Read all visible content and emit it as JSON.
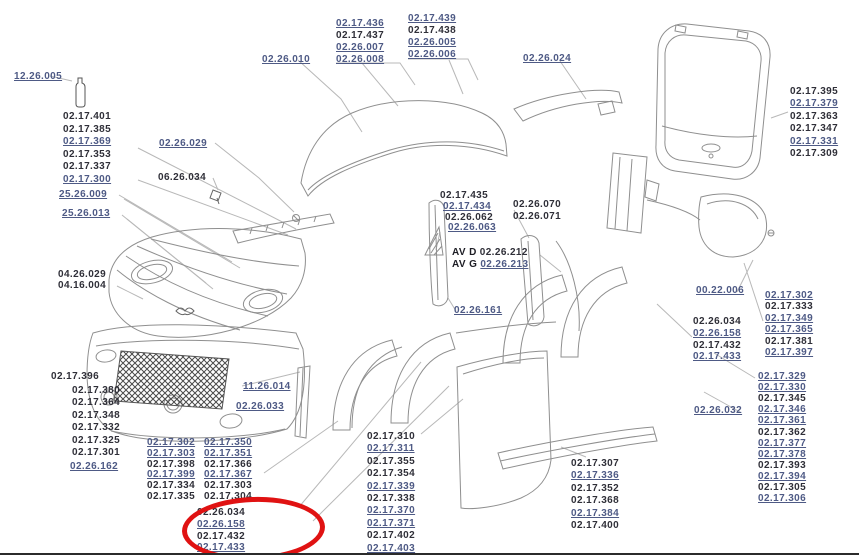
{
  "colors": {
    "text": "#2f2f38",
    "link": "#4e5a85",
    "art": "#8f8f8f",
    "leader": "#b8b8b8",
    "highlight": "#e01212",
    "background": "#ffffff"
  },
  "callouts": [
    {
      "id": "12-26-005",
      "t": "12.26.005",
      "x": 14,
      "y": 71,
      "link": true
    },
    {
      "id": "02-26-010",
      "t": "02.26.010",
      "x": 262,
      "y": 54,
      "link": true
    },
    {
      "id": "02-26-029",
      "t": "02.26.029",
      "x": 159,
      "y": 138,
      "link": true
    },
    {
      "id": "06-26-034",
      "t": "06.26.034",
      "x": 158,
      "y": 172,
      "link": false
    },
    {
      "id": "25-26-009",
      "t": "25.26.009",
      "x": 59,
      "y": 189,
      "link": true
    },
    {
      "id": "25-26-013",
      "t": "25.26.013",
      "x": 62,
      "y": 208,
      "link": true
    },
    {
      "id": "04-26-029",
      "t": "04.26.029",
      "x": 58,
      "y": 269,
      "link": false
    },
    {
      "id": "04-16-004",
      "t": "04.16.004",
      "x": 58,
      "y": 280,
      "link": false
    },
    {
      "id": "02-26-024",
      "t": "02.26.024",
      "x": 523,
      "y": 53,
      "link": true
    },
    {
      "id": "00-22-006",
      "t": "00.22.006",
      "x": 696,
      "y": 285,
      "link": true
    },
    {
      "id": "02-26-032",
      "t": "02.26.032",
      "x": 694,
      "y": 405,
      "link": true
    },
    {
      "id": "11-26-014",
      "t": "11.26.014",
      "x": 243,
      "y": 381,
      "link": true
    },
    {
      "id": "02-26-033",
      "t": "02.26.033",
      "x": 236,
      "y": 401,
      "link": true
    },
    {
      "id": "02-26-162",
      "t": "02.26.162",
      "x": 70,
      "y": 461,
      "link": true
    },
    {
      "id": "02-26-161",
      "t": "02.26.161",
      "x": 454,
      "y": 305,
      "link": true
    },
    {
      "id": "av-d-02-26-212",
      "prefix": "AV D",
      "t": "02.26.212",
      "x": 452,
      "y": 247,
      "link": false
    },
    {
      "id": "av-g-02-26-213",
      "prefix": "AV G",
      "t": "02.26.213",
      "x": 452,
      "y": 259,
      "link": true
    }
  ],
  "lists": [
    {
      "id": "front-left-upper",
      "x": 63,
      "y": 111,
      "lh": 12.5,
      "items": [
        {
          "t": "02.17.401"
        },
        {
          "t": "02.17.385"
        },
        {
          "t": "02.17.369",
          "u": true
        },
        {
          "t": "02.17.353"
        },
        {
          "t": "02.17.337"
        },
        {
          "t": "02.17.300",
          "u": true
        }
      ]
    },
    {
      "id": "top-center-left",
      "x": 336,
      "y": 18,
      "lh": 12,
      "items": [
        {
          "t": "02.17.436",
          "u": true
        },
        {
          "t": "02.17.437"
        },
        {
          "t": "02.26.007",
          "u": true
        },
        {
          "t": "02.26.008",
          "u": true
        }
      ]
    },
    {
      "id": "top-center-right",
      "x": 408,
      "y": 13,
      "lh": 12,
      "items": [
        {
          "t": "02.17.439",
          "u": true
        },
        {
          "t": "02.17.438"
        },
        {
          "t": "02.26.005",
          "u": true
        },
        {
          "t": "02.26.006",
          "u": true
        }
      ]
    },
    {
      "id": "hatch-right",
      "x": 790,
      "y": 86,
      "lh": 12.4,
      "items": [
        {
          "t": "02.17.395"
        },
        {
          "t": "02.17.379",
          "u": true
        },
        {
          "t": "02.17.363"
        },
        {
          "t": "02.17.347"
        },
        {
          "t": "02.17.331",
          "u": true
        },
        {
          "t": "02.17.309"
        }
      ]
    },
    {
      "id": "center-pillar",
      "x": 440,
      "y": 190,
      "lh": 10.8,
      "items": [
        {
          "t": "02.17.435"
        },
        {
          "t": "02.17.434",
          "u": true,
          "dx": 3
        },
        {
          "t": "02.26.062",
          "dx": 5
        },
        {
          "t": "02.26.063",
          "u": true,
          "dx": 8
        }
      ]
    },
    {
      "id": "quarter-upper",
      "x": 513,
      "y": 199,
      "lh": 11.5,
      "items": [
        {
          "t": "02.26.070"
        },
        {
          "t": "02.26.071"
        }
      ]
    },
    {
      "id": "rear-inner",
      "x": 693,
      "y": 316,
      "lh": 11.8,
      "items": [
        {
          "t": "02.26.034"
        },
        {
          "t": "02.26.158",
          "u": true
        },
        {
          "t": "02.17.432"
        },
        {
          "t": "02.17.433",
          "u": true
        }
      ]
    },
    {
      "id": "rear-outer",
      "x": 765,
      "y": 290,
      "lh": 11.4,
      "items": [
        {
          "t": "02.17.302",
          "u": true
        },
        {
          "t": "02.17.333"
        },
        {
          "t": "02.17.349",
          "u": true
        },
        {
          "t": "02.17.365",
          "u": true
        },
        {
          "t": "02.17.381"
        },
        {
          "t": "02.17.397",
          "u": true
        }
      ]
    },
    {
      "id": "rear-lower",
      "x": 758,
      "y": 371,
      "lh": 11.1,
      "items": [
        {
          "t": "02.17.329",
          "u": true
        },
        {
          "t": "02.17.330",
          "u": true
        },
        {
          "t": "02.17.345"
        },
        {
          "t": "02.17.346",
          "u": true
        },
        {
          "t": "02.17.361",
          "u": true
        },
        {
          "t": "02.17.362"
        },
        {
          "t": "02.17.377",
          "u": true
        },
        {
          "t": "02.17.378",
          "u": true
        },
        {
          "t": "02.17.393"
        },
        {
          "t": "02.17.394",
          "u": true
        },
        {
          "t": "02.17.305"
        },
        {
          "t": "02.17.306",
          "u": true
        }
      ]
    },
    {
      "id": "bumper-left-head",
      "x": 51,
      "y": 371,
      "lh": 13,
      "items": [
        {
          "t": "02.17.396"
        }
      ]
    },
    {
      "id": "bumper-left",
      "x": 72,
      "y": 385,
      "lh": 12.4,
      "items": [
        {
          "t": "02.17.380"
        },
        {
          "t": "02.17.364"
        },
        {
          "t": "02.17.348"
        },
        {
          "t": "02.17.332"
        },
        {
          "t": "02.17.325"
        },
        {
          "t": "02.17.301"
        }
      ]
    },
    {
      "id": "bumper-bottom-a",
      "x": 147,
      "y": 437,
      "lh": 10.8,
      "items": [
        {
          "t": "02.17.302",
          "u": true
        },
        {
          "t": "02.17.303",
          "u": true
        },
        {
          "t": "02.17.398"
        },
        {
          "t": "02.17.399",
          "u": true
        },
        {
          "t": "02.17.334"
        },
        {
          "t": "02.17.335"
        }
      ]
    },
    {
      "id": "bumper-bottom-b",
      "x": 204,
      "y": 437,
      "lh": 10.8,
      "items": [
        {
          "t": "02.17.350",
          "u": true
        },
        {
          "t": "02.17.351",
          "u": true
        },
        {
          "t": "02.17.366"
        },
        {
          "t": "02.17.367",
          "u": true
        },
        {
          "t": "02.17.303"
        },
        {
          "t": "02.17.304"
        }
      ]
    },
    {
      "id": "circled",
      "x": 197,
      "y": 507,
      "lh": 11.8,
      "items": [
        {
          "t": "02.26.034"
        },
        {
          "t": "02.26.158",
          "u": true
        },
        {
          "t": "02.17.432"
        },
        {
          "t": "02.17.433",
          "u": true
        }
      ]
    },
    {
      "id": "door",
      "x": 367,
      "y": 431,
      "lh": 12.4,
      "items": [
        {
          "t": "02.17.310"
        },
        {
          "t": "02.17.311",
          "u": true
        },
        {
          "t": "02.17.355"
        },
        {
          "t": "02.17.354"
        },
        {
          "t": "02.17.339",
          "u": true
        },
        {
          "t": "02.17.338"
        },
        {
          "t": "02.17.370",
          "u": true
        },
        {
          "t": "02.17.371",
          "u": true
        },
        {
          "t": "02.17.402"
        },
        {
          "t": "02.17.403",
          "u": true
        }
      ]
    },
    {
      "id": "skirt",
      "x": 571,
      "y": 458,
      "lh": 12.4,
      "items": [
        {
          "t": "02.17.307"
        },
        {
          "t": "02.17.336",
          "u": true
        },
        {
          "t": "02.17.352"
        },
        {
          "t": "02.17.368"
        },
        {
          "t": "02.17.384",
          "u": true
        },
        {
          "t": "02.17.400"
        }
      ]
    }
  ],
  "highlight": {
    "x": 182,
    "y": 497,
    "w": 133,
    "h": 54,
    "rotate": -2
  }
}
